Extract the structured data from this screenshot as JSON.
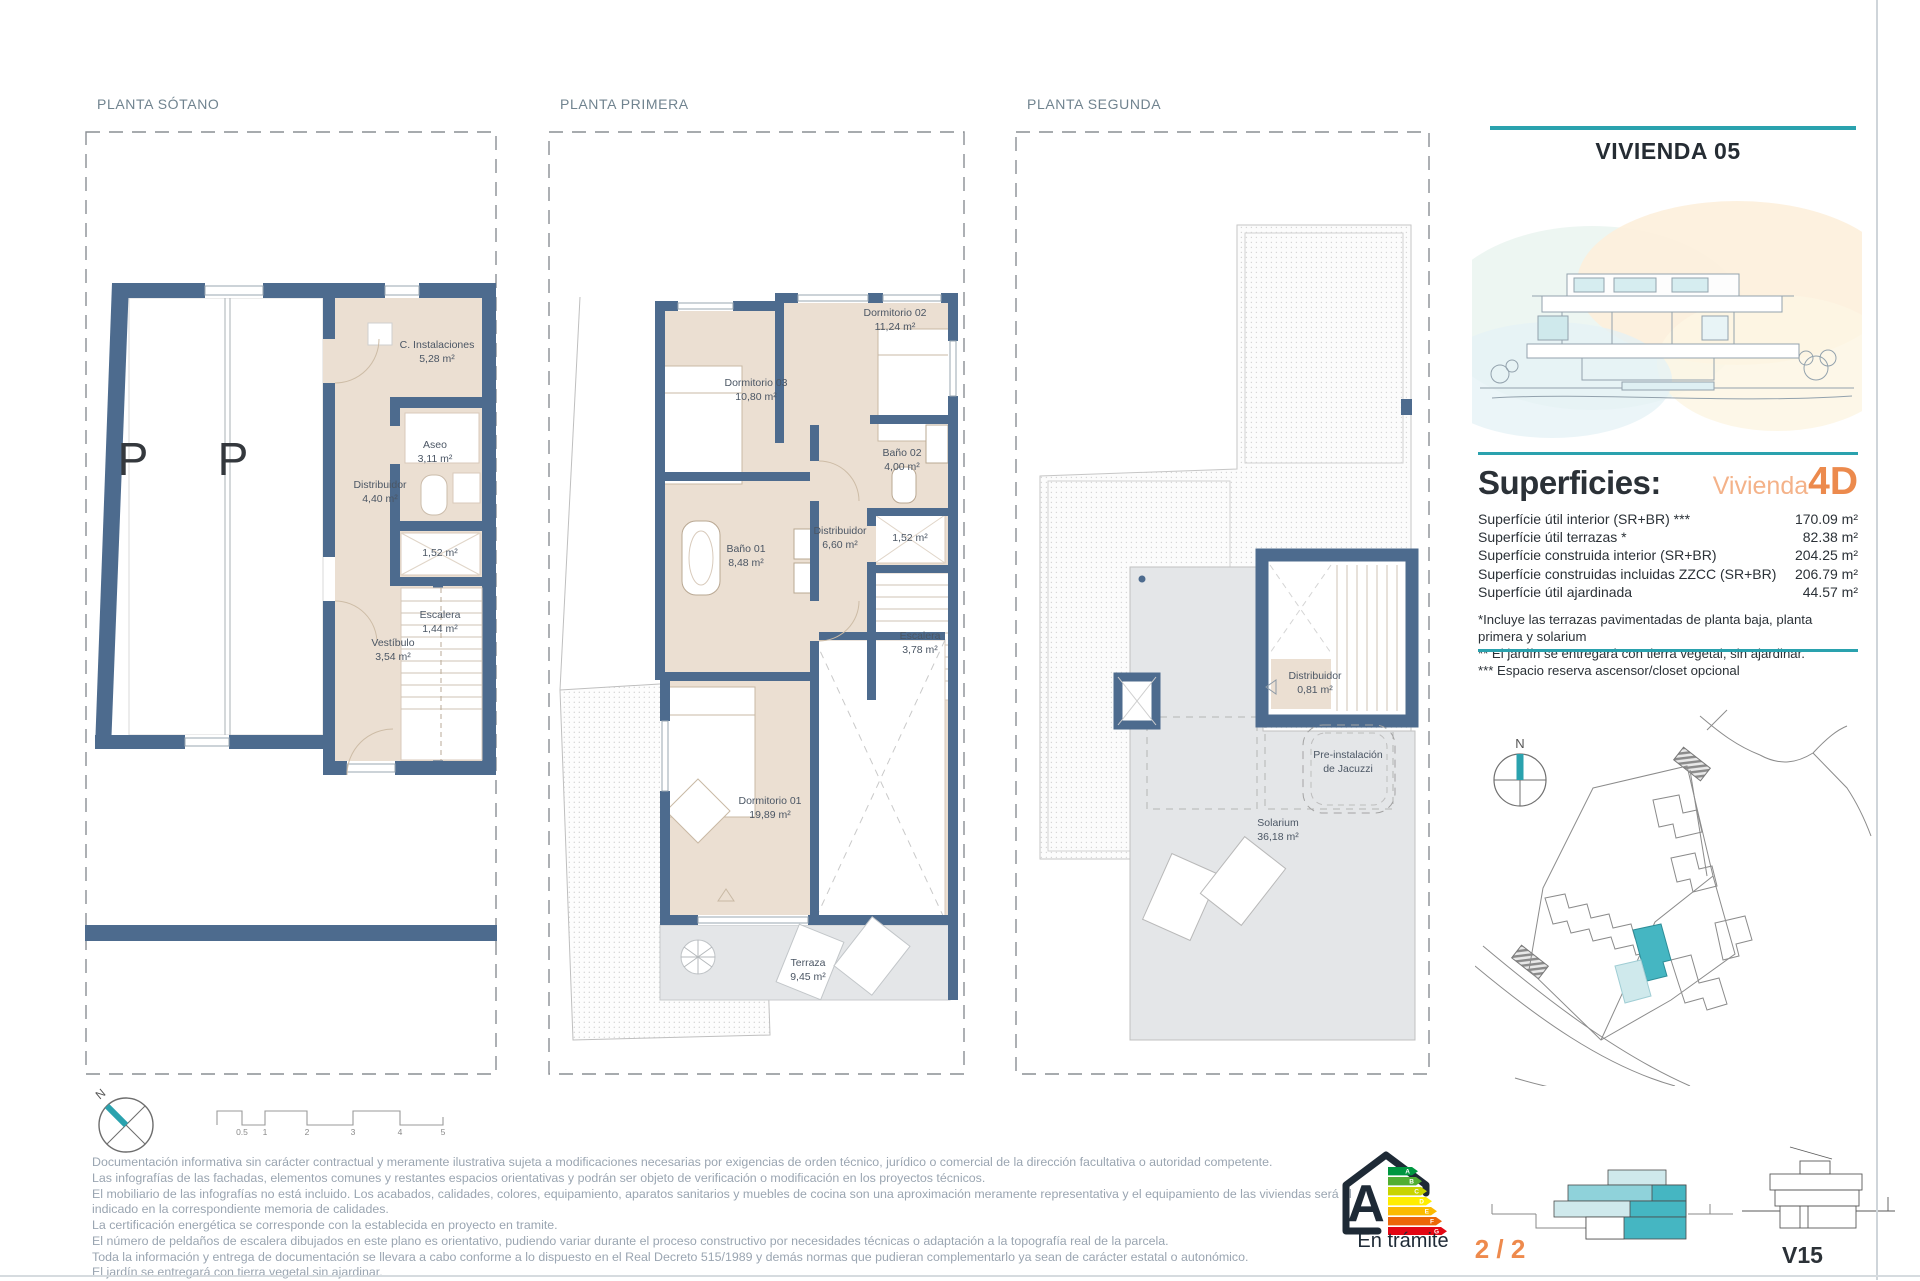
{
  "header": {
    "title": "VIVIENDA 05"
  },
  "plans": [
    {
      "label": "PLANTA SÓTANO",
      "parking": [
        "P",
        "P"
      ],
      "rooms": [
        {
          "name": "C. Instalaciones",
          "area": "5,28 m²"
        },
        {
          "name": "Aseo",
          "area": "3,11 m²"
        },
        {
          "name": "Distribuidor",
          "area": "4,40 m²"
        },
        {
          "name": "",
          "area": "1,52 m²"
        },
        {
          "name": "Escalera",
          "area": "1,44 m²"
        },
        {
          "name": "Vestíbulo",
          "area": "3,54 m²"
        }
      ]
    },
    {
      "label": "PLANTA PRIMERA",
      "rooms": [
        {
          "name": "Dormitorio 02",
          "area": "11,24 m²"
        },
        {
          "name": "Dormitorio 03",
          "area": "10,80 m²"
        },
        {
          "name": "Baño 02",
          "area": "4,00 m²"
        },
        {
          "name": "Baño 01",
          "area": "8,48 m²"
        },
        {
          "name": "Distribuidor",
          "area": "6,60 m²"
        },
        {
          "name": "",
          "area": "1,52 m²"
        },
        {
          "name": "Escalera",
          "area": "3,78 m²"
        },
        {
          "name": "Dormitorio 01",
          "area": "19,89 m²"
        },
        {
          "name": "Terraza",
          "area": "9,45 m²"
        }
      ]
    },
    {
      "label": "PLANTA SEGUNDA",
      "rooms": [
        {
          "name": "Distribuidor",
          "area": "0,81 m²"
        },
        {
          "name": "Pre-instalación",
          "area": "de Jacuzzi"
        },
        {
          "name": "Solarium",
          "area": "36,18 m²"
        }
      ]
    }
  ],
  "superficies": {
    "heading": "Superficies:",
    "vivienda_word": "Vivienda",
    "vivienda_code": "4D",
    "rows": [
      {
        "label": "Superfície útil interior (SR+BR) ***",
        "value": "170.09 m²"
      },
      {
        "label": "Superfície útil terrazas *",
        "value": "82.38 m²"
      },
      {
        "label": "Superfície construida interior (SR+BR)",
        "value": "204.25 m²"
      },
      {
        "label": "Superfície construidas incluidas ZZCC (SR+BR)",
        "value": "206.79 m²"
      },
      {
        "label": "Superfície útil ajardinada",
        "value": "44.57 m²"
      }
    ],
    "footnotes": [
      "*Incluye las terrazas pavimentadas de planta baja, planta primera y solarium",
      "** El jardín se entregará con tierra vegetal, sin ajardinar.",
      "*** Espacio reserva ascensor/closet opcional"
    ]
  },
  "compass": {
    "north": "N"
  },
  "scale_bar": {
    "ticks": [
      "0.5",
      "1",
      "2",
      "3",
      "4",
      "5"
    ]
  },
  "disclaimer": {
    "lines": [
      "Documentación informativa sin carácter contractual y meramente ilustrativa sujeta a modificaciones necesarias por exigencias de orden técnico, jurídico o comercial de la dirección facultativa o autoridad competente.",
      "Las infografías de las fachadas, elementos comunes y restantes espacios orientativas y podrán ser objeto de verificación o modificación en los proyectos técnicos.",
      "El mobiliario de las infografías no está incluido. Los acabados, calidades, colores, equipamiento, aparatos sanitarios y muebles de cocina son una aproximación meramente representativa y el equipamiento de las viviendas será el",
      "indicado en la correspondiente memoria de calidades.",
      "La certificación energética se corresponde con la establecida en proyecto en tramite.",
      "El número de peldaños de escalera dibujados en este plano es orientativo, pudiendo variar durante el proceso constructivo por necesidades técnicas o adaptación a la topografía real de la parcela.",
      "Toda la información y entrega de documentación se llevara a cabo conforme a lo dispuesto en el Real Decreto 515/1989 y demás normas que pudieran complementarlo ya sean de carácter estatal o autonómico.",
      "El jardín se entregará con tierra vegetal sin ajardinar."
    ]
  },
  "energy": {
    "letter": "A",
    "bars": [
      "A",
      "B",
      "C",
      "D",
      "E",
      "F",
      "G"
    ],
    "status": "En trámite"
  },
  "footer": {
    "page_indicator": "2 / 2",
    "sheet_code": "V15"
  },
  "colors": {
    "wall_blue": "#4d6b8e",
    "room_beige": "#ebdfd2",
    "terrace_gray": "#e4e6e8",
    "accent_teal": "#2aa2ae",
    "highlight_teal": "#45b6c2",
    "accent_orange": "#ec8a4d"
  }
}
